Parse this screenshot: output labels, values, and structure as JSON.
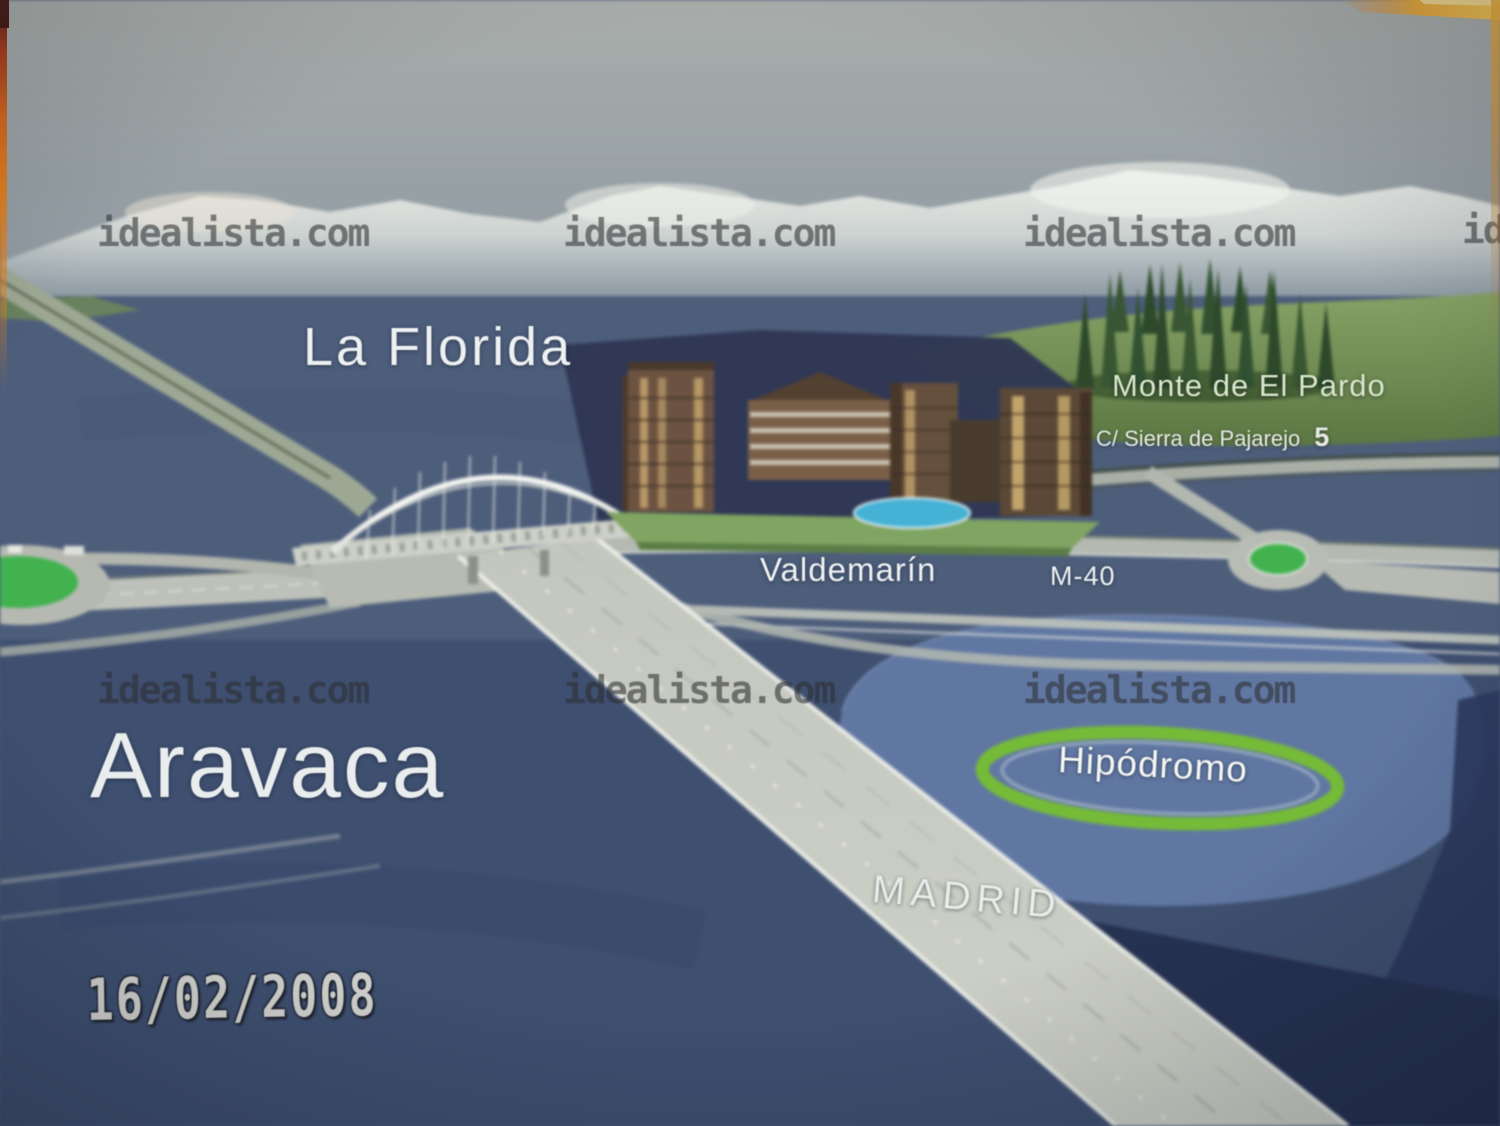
{
  "photo": {
    "date_stamp": "16/02/2008",
    "description": "Photograph of an illustrated aerial promotional map of a residential development"
  },
  "watermark": {
    "text": "idealista.com"
  },
  "labels": {
    "la_florida": "La Florida",
    "aravaca": "Aravaca",
    "valdemarin": "Valdemarín",
    "m40": "M-40",
    "madrid": "MADRID",
    "hipodromo": "Hipódromo",
    "monte_de_el_pardo": "Monte de El Pardo",
    "street_name": "C/ Sierra de Pajarejo",
    "street_number": "5"
  },
  "colors": {
    "sky_gray": "#96a1a7",
    "terrain_blue": "#4b5d7c",
    "plateau_blue": "#5f77a5",
    "road_gray": "#c6c9c0",
    "roundabout_green": "#3db44b",
    "track_green": "#72bd30",
    "forest_green": "#2e4d2b",
    "frame_orange": "#d87a1e",
    "label_white": "#eef1f2"
  }
}
